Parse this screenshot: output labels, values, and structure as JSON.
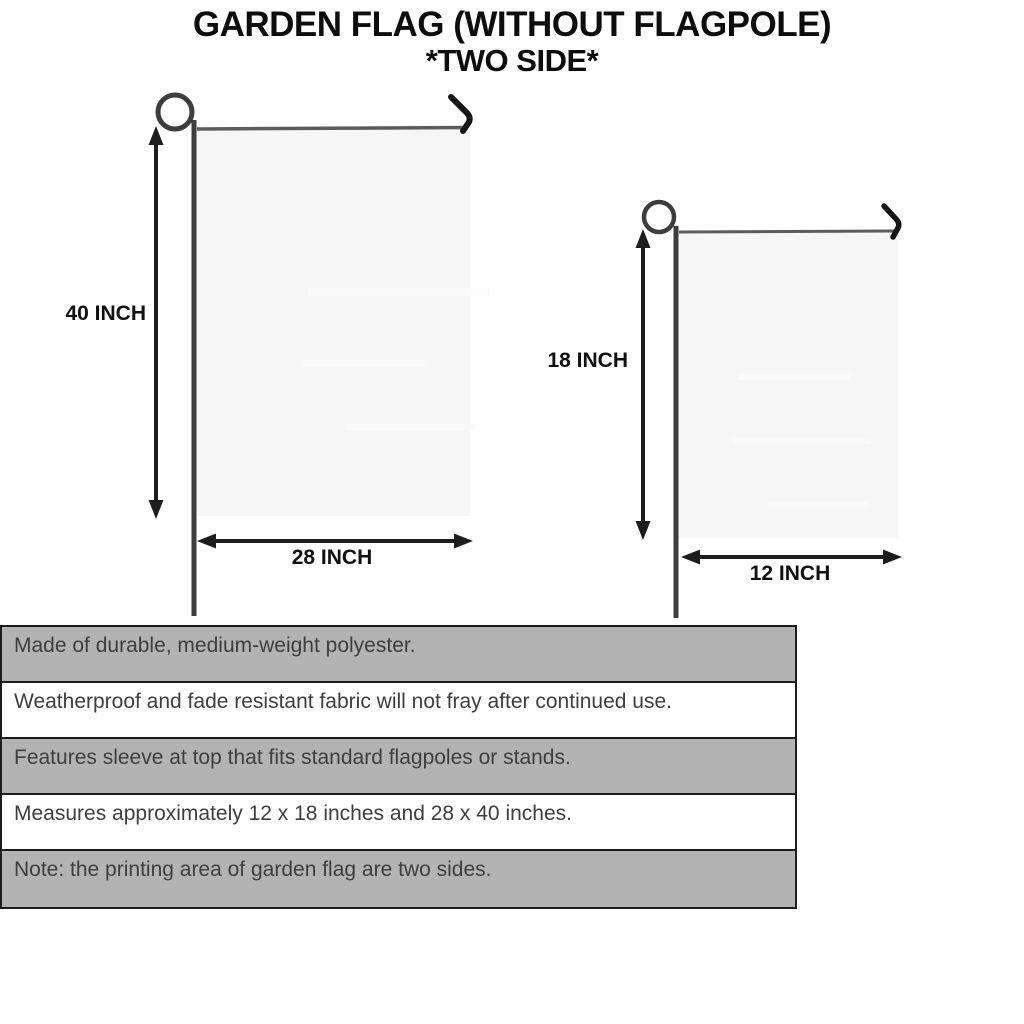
{
  "title": {
    "line1": "GARDEN FLAG (WITHOUT FLAGPOLE)",
    "line2": "*TWO SIDE*"
  },
  "diagram": {
    "large_flag": {
      "height_label": "40 INCH",
      "width_label": "28 INCH"
    },
    "small_flag": {
      "height_label": "18 INCH",
      "width_label": "12 INCH"
    }
  },
  "table": {
    "rows": [
      "Made of durable, medium-weight polyester.",
      "Weatherproof and fade resistant fabric will not fray after continued use.",
      "Features sleeve at top that fits standard flagpoles or stands.",
      "Measures approximately 12 x 18 inches and 28 x 40 inches.",
      "Note: the printing area of garden flag are two sides."
    ]
  },
  "colors": {
    "title_ink": "#0d0d0d",
    "label_ink": "#101010",
    "row_gray": "#b3b3b3",
    "table_border": "#1c1c1c",
    "table_ink": "#3e3e3e",
    "flag_fill": "#f6f6f6",
    "pole": "#3d3d3d",
    "rod": "#5c5c5c",
    "hook": "#161616",
    "arrow": "#1d1d1d"
  }
}
